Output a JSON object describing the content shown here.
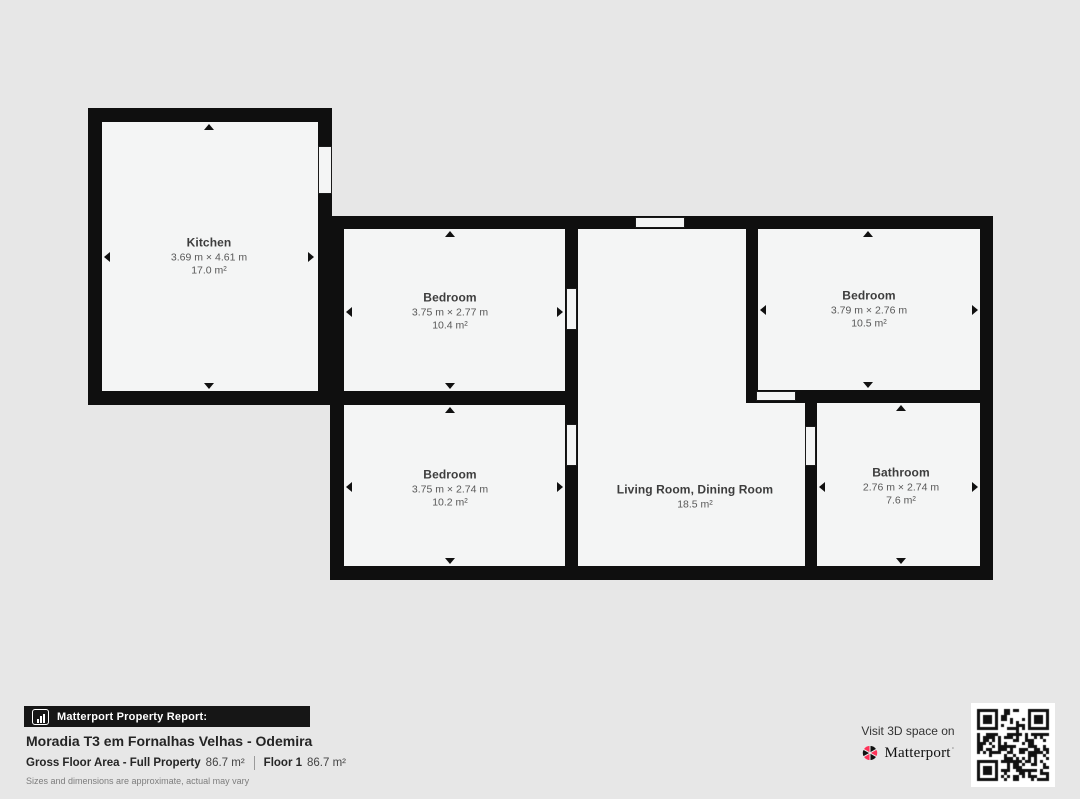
{
  "floorplan": {
    "rooms": {
      "kitchen": {
        "name": "Kitchen",
        "dims": "3.69 m × 4.61 m",
        "area": "17.0 m²"
      },
      "bedroom_top": {
        "name": "Bedroom",
        "dims": "3.75 m × 2.77 m",
        "area": "10.4 m²"
      },
      "bedroom_right": {
        "name": "Bedroom",
        "dims": "3.79 m × 2.76 m",
        "area": "10.5 m²"
      },
      "bedroom_bottom": {
        "name": "Bedroom",
        "dims": "3.75 m × 2.74 m",
        "area": "10.2 m²"
      },
      "living": {
        "name": "Living Room, Dining Room",
        "area": "18.5 m²"
      },
      "bathroom": {
        "name": "Bathroom",
        "dims": "2.76 m × 2.74 m",
        "area": "7.6 m²"
      }
    }
  },
  "report": {
    "bar_label": "Matterport Property Report:",
    "title": "Moradia T3 em Fornalhas Velhas - Odemira",
    "gross_floor_area_label": "Gross Floor Area - Full Property",
    "gross_floor_area_value": "86.7 m²",
    "floor_label": "Floor 1",
    "floor_value": "86.7 m²",
    "disclaimer": "Sizes and dimensions are approximate, actual may vary"
  },
  "promo": {
    "visit_text": "Visit 3D space on",
    "brand": "Matterport",
    "brand_tm": "·"
  },
  "colors": {
    "background": "#e7e7e7",
    "wall": "#0f0f0f",
    "room_fill": "#f4f5f5",
    "brand_red": "#ff3158",
    "bar_background": "#161616"
  }
}
